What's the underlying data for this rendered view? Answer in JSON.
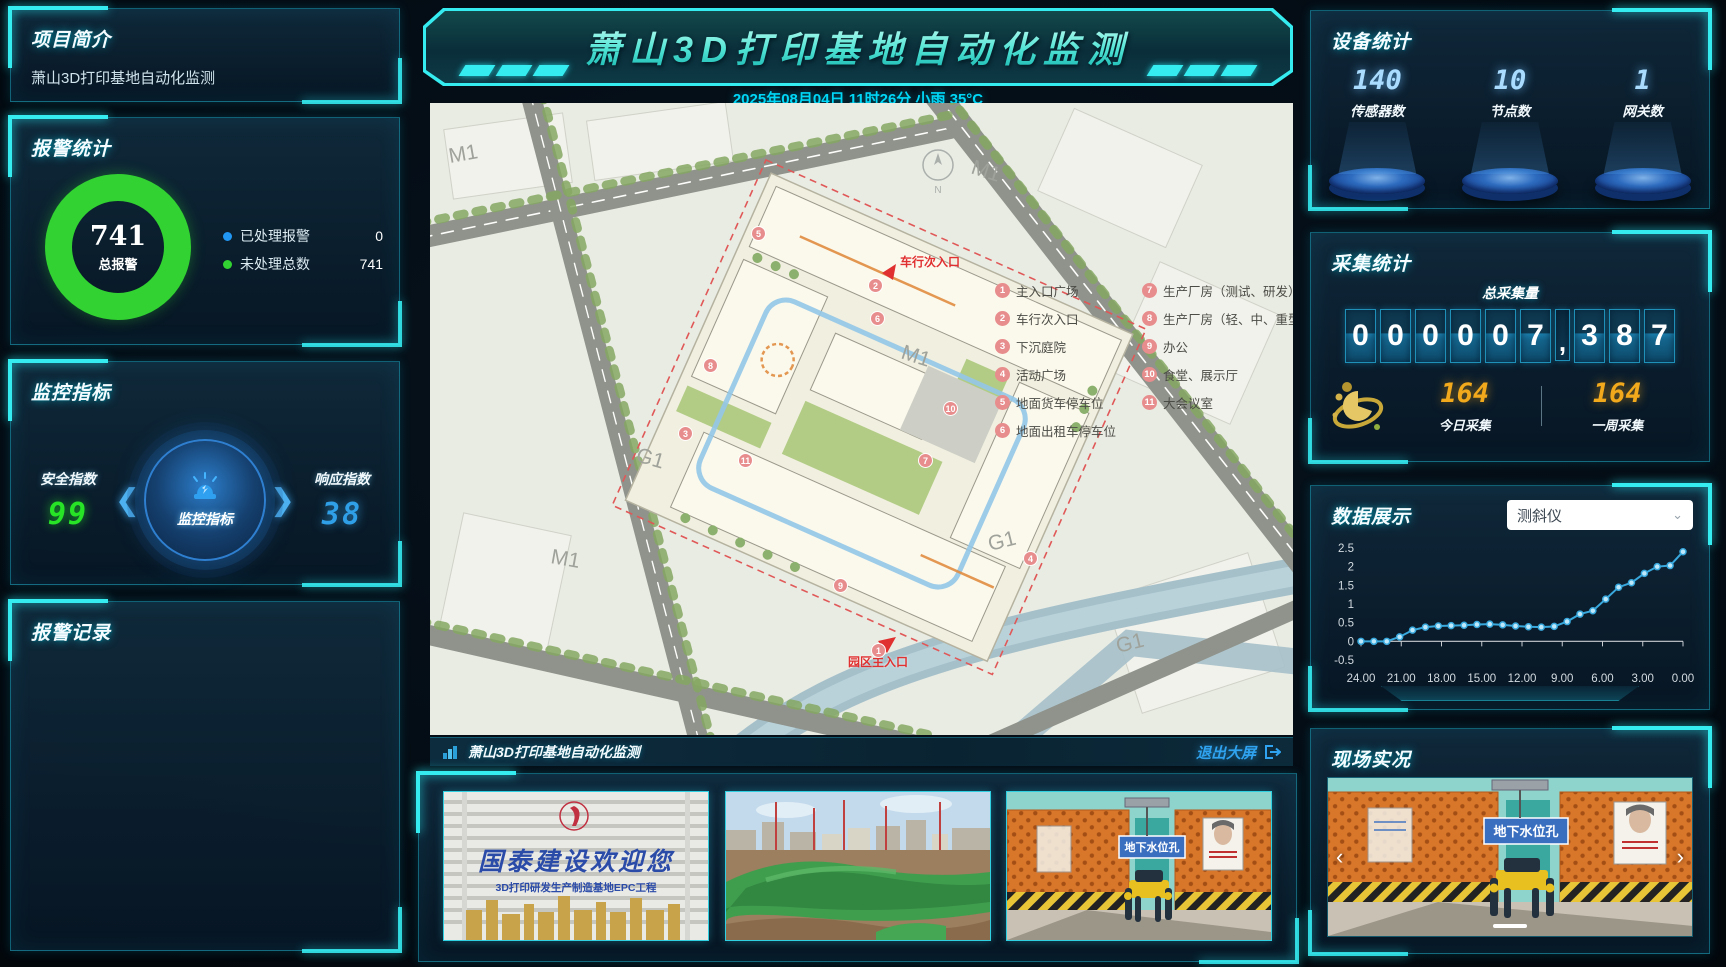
{
  "banner": {
    "title": "萧山3D打印基地自动化监测",
    "datetime": "2025年08月04日 11时26分 小雨 35°C"
  },
  "left": {
    "project": {
      "title": "项目简介",
      "description": "萧山3D打印基地自动化监测"
    },
    "alarm": {
      "title": "报警统计",
      "total_value": "741",
      "total_label": "总报警",
      "legend": [
        {
          "label": "已处理报警",
          "value": "0",
          "color": "#2196f3"
        },
        {
          "label": "未处理总数",
          "value": "741",
          "color": "#31d231"
        }
      ]
    },
    "monitor": {
      "title": "监控指标",
      "left_label": "安全指数",
      "left_value": "99",
      "badge_label": "监控指标",
      "right_label": "响应指数",
      "right_value": "38"
    },
    "records": {
      "title": "报警记录"
    }
  },
  "map": {
    "m1": "M1",
    "g1": "G1",
    "compass": "N",
    "entry_top": "车行次入口",
    "entry_bottom": "园区主入口",
    "legend": [
      {
        "num": "1",
        "label": "主入口广场"
      },
      {
        "num": "2",
        "label": "车行次入口"
      },
      {
        "num": "3",
        "label": "下沉庭院"
      },
      {
        "num": "4",
        "label": "活动广场"
      },
      {
        "num": "5",
        "label": "地面货车停车位"
      },
      {
        "num": "6",
        "label": "地面出租车停车位"
      },
      {
        "num": "7",
        "label": "生产厂房（测试、研发）"
      },
      {
        "num": "8",
        "label": "生产厂房（轻、中、重型）"
      },
      {
        "num": "9",
        "label": "办公"
      },
      {
        "num": "10",
        "label": "食堂、展示厅"
      },
      {
        "num": "11",
        "label": "大会议室"
      }
    ]
  },
  "footer": {
    "title": "萧山3D打印基地自动化监测",
    "exit_label": "退出大屏"
  },
  "carousel": {
    "photo1": {
      "line1": "国泰建设欢迎您",
      "line2": "3D打印研发生产制造基地EPC工程"
    },
    "photo3": {
      "sign": "地下水位孔"
    }
  },
  "right": {
    "device": {
      "title": "设备统计",
      "stats": [
        {
          "value": "140",
          "label": "传感器数"
        },
        {
          "value": "10",
          "label": "节点数"
        },
        {
          "value": "1",
          "label": "网关数"
        }
      ]
    },
    "collect": {
      "title": "采集统计",
      "subtitle": "总采集量",
      "digits": [
        "0",
        "0",
        "0",
        "0",
        "0",
        "7",
        ",",
        "3",
        "8",
        "7"
      ],
      "today_value": "164",
      "today_label": "今日采集",
      "week_value": "164",
      "week_label": "一周采集"
    },
    "display": {
      "title": "数据展示",
      "select_value": "测斜仪"
    },
    "live": {
      "title": "现场实况",
      "sign": "地下水位孔"
    }
  },
  "chart_data": [
    {
      "type": "pie",
      "title": "报警统计",
      "labels": [
        "已处理报警",
        "未处理总数"
      ],
      "values": [
        0,
        741
      ],
      "colors": [
        "#2196f3",
        "#31d231"
      ],
      "center_value": 741,
      "center_label": "总报警"
    },
    {
      "type": "line",
      "title": "数据展示（测斜仪）",
      "xticks": [
        "24.00",
        "21.00",
        "18.00",
        "15.00",
        "12.00",
        "9.00",
        "6.00",
        "3.00",
        "0.00"
      ],
      "values": [
        0,
        0,
        0,
        0.12,
        0.3,
        0.38,
        0.41,
        0.42,
        0.43,
        0.45,
        0.46,
        0.44,
        0.41,
        0.39,
        0.38,
        0.4,
        0.53,
        0.73,
        0.82,
        1.13,
        1.45,
        1.57,
        1.82,
        2.0,
        2.03,
        2.4
      ],
      "yticks": [
        -0.5,
        0,
        0.5,
        1,
        1.5,
        2,
        2.5
      ],
      "ylim": [
        -0.5,
        2.5
      ],
      "line_color": "#38a8dd",
      "grid": false,
      "legend_position": "none"
    }
  ]
}
